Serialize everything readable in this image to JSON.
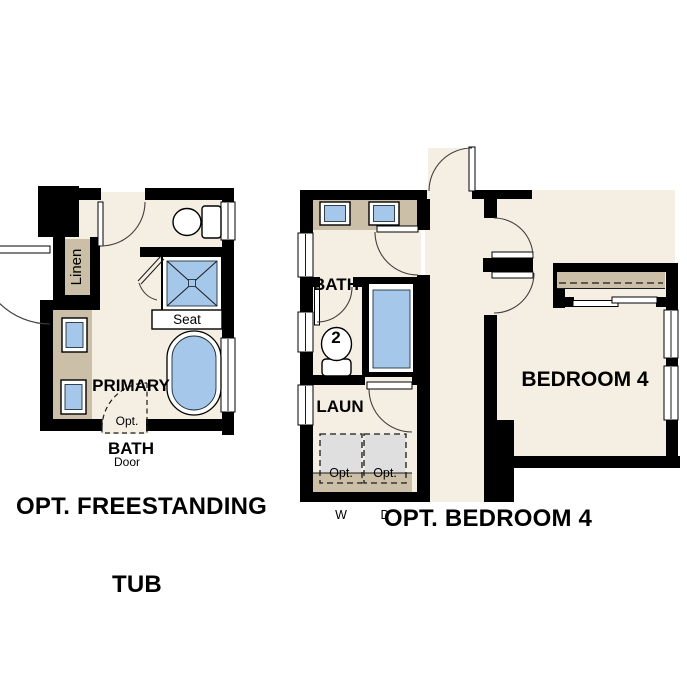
{
  "colors": {
    "wall": "#000000",
    "floor": "#F5EEE2",
    "counter": "#CBBFA7",
    "fixture": "#A5C7E9",
    "appliance": "#DFDFDF"
  },
  "left_plan": {
    "caption": {
      "line1": "OPT. FREESTANDING",
      "line2": "TUB"
    },
    "labels": {
      "room_line1": "PRIMARY",
      "room_line2": "BATH",
      "linen": "Linen",
      "seat": "Seat",
      "opt_door_line1": "Opt.",
      "opt_door_line2": "Door"
    },
    "fixtures": [
      "linen-closet",
      "vanity-two-sinks",
      "toilet",
      "shower-with-seat",
      "freestanding-tub",
      "optional-door"
    ]
  },
  "right_plan": {
    "caption": "OPT. BEDROOM 4",
    "labels": {
      "bath_line1": "BATH",
      "bath_line2": "2",
      "laundry": "LAUN",
      "washer_line1": "Opt.",
      "washer_line2": "W",
      "dryer_line1": "Opt.",
      "dryer_line2": "D",
      "bedroom": "BEDROOM 4"
    },
    "fixtures": [
      "vanity-two-sinks",
      "toilet",
      "shower",
      "optional-washer",
      "optional-dryer",
      "laundry-counter",
      "closet-with-bypass-doors"
    ]
  }
}
